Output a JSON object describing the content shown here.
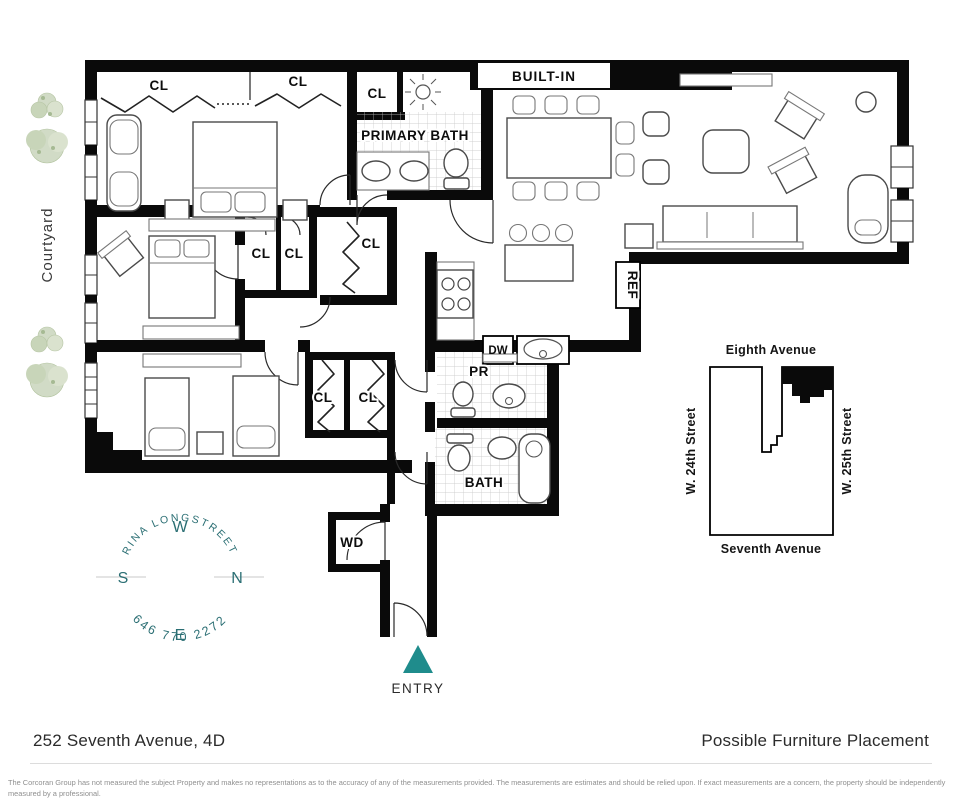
{
  "colors": {
    "teal": "#1f8c8c",
    "compass_teal": "#2a6e73",
    "wall": "#0a0a0a",
    "tree": "#ccd7bf"
  },
  "plan": {
    "cl": "CL",
    "primary_bath": "PRIMARY BATH",
    "built_in": "BUILT-IN",
    "ref": "REF",
    "dw": "DW",
    "pr": "PR",
    "bath": "BATH",
    "wd": "WD",
    "entry": "ENTRY",
    "courtyard": "Courtyard"
  },
  "compass": {
    "w": "W",
    "n": "N",
    "e": "E",
    "s": "S",
    "agent_name": "RINA LONGSTREET",
    "agent_phone": "646 770 2272"
  },
  "map": {
    "top": "Eighth Avenue",
    "bottom": "Seventh Avenue",
    "left": "W. 24th Street",
    "right": "W. 25th Street"
  },
  "footer": {
    "address": "252 Seventh Avenue, 4D",
    "title": "Possible Furniture Placement",
    "disclaimer": "The Corcoran Group has not measured the subject Property and makes no representations as to the accuracy of any of the measurements provided. The measurements are estimates and should be relied upon. If exact measurements are a concern, the property should be independently measured by a professional."
  }
}
